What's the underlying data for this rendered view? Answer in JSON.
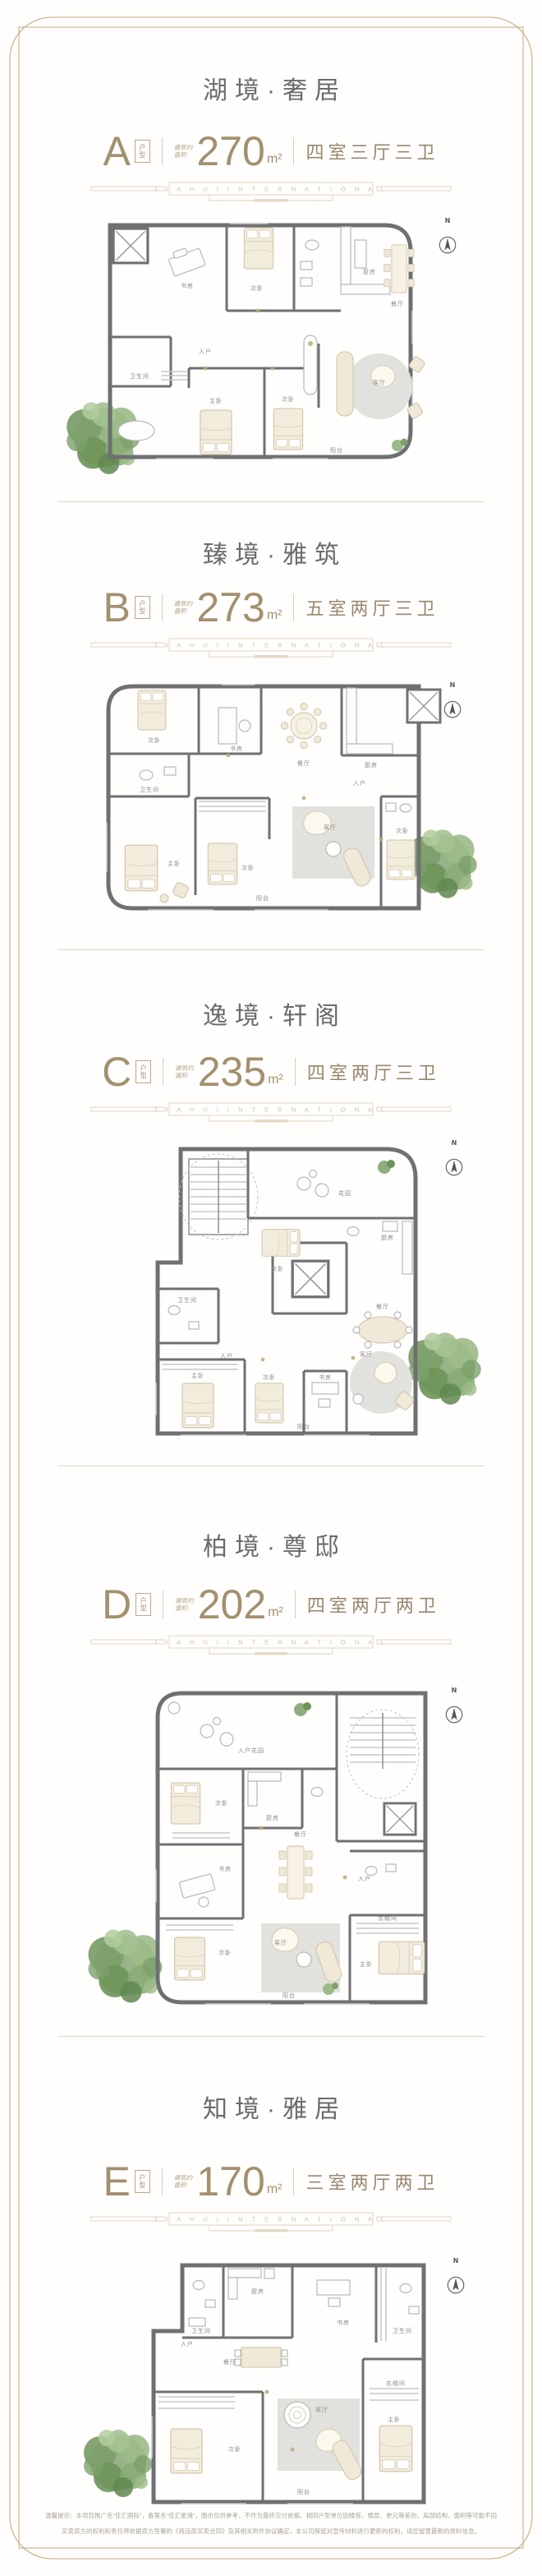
{
  "page": {
    "brand_divider": "J I A H U I   I N T E R N A T I O N A L",
    "north_label": "N",
    "type_box_top": "户",
    "type_box_bottom": "型",
    "area_note_line1": "建筑约",
    "area_note_line2": "面积",
    "disclaimer_line1": "温馨提示：本项目推广名“佳汇国际”，备案名“佳汇星滩”，图示仅供参考，不作为最终交付依据。相同户型单位因楼栋、楼层、单元等差别，局部结构、面积等可能不同，最终以实际交付为准。",
    "disclaimer_line2": "买卖双方的权利和责任将依据双方签署的《商品房买卖合同》及其相关附件协议确定，本公司保留对宣传材料进行更新的权利，请您留意最新的资料信息。"
  },
  "palette": {
    "accent_taupe": "#a3906f",
    "title_gray": "#6b6b6b",
    "frame_gold": "#c2aa7a",
    "wall_gray": "#6e7072",
    "tree_green": "#8fae7e"
  },
  "sections": [
    {
      "id": "A",
      "title": "湖境·奢居",
      "letter": "A",
      "area": "270",
      "unit": "m²",
      "layout": "四室三厅三卫",
      "rooms": [
        "书房",
        "次卧",
        "厨房",
        "餐厅",
        "入户",
        "卫生间",
        "主卧",
        "次卧",
        "客厅",
        "阳台"
      ]
    },
    {
      "id": "B",
      "title": "臻境·雅筑",
      "letter": "B",
      "area": "273",
      "unit": "m²",
      "layout": "五室两厅三卫",
      "rooms": [
        "次卧",
        "书房",
        "餐厅",
        "厨房",
        "卫生间",
        "入户",
        "主卧",
        "次卧",
        "客厅",
        "次卧",
        "阳台"
      ]
    },
    {
      "id": "C",
      "title": "逸境·轩阁",
      "letter": "C",
      "area": "235",
      "unit": "m²",
      "layout": "四室两厅三卫",
      "rooms": [
        "花园",
        "次卧",
        "厨房",
        "餐厅",
        "入户",
        "卫生间",
        "主卧",
        "次卧",
        "书房",
        "客厅",
        "阳台"
      ]
    },
    {
      "id": "D",
      "title": "柏境·尊邸",
      "letter": "D",
      "area": "202",
      "unit": "m²",
      "layout": "四室两厅两卫",
      "rooms": [
        "入户花园",
        "次卧",
        "厨房",
        "餐厅",
        "入户",
        "书房",
        "次卧",
        "客厅",
        "主卧",
        "衣帽间",
        "阳台"
      ]
    },
    {
      "id": "E",
      "title": "知境·雅居",
      "letter": "E",
      "area": "170",
      "unit": "m²",
      "layout": "三室两厅两卫",
      "rooms": [
        "卫生间",
        "厨房",
        "餐厅",
        "书房",
        "卫生间",
        "入户",
        "次卧",
        "客厅",
        "主卧",
        "衣帽间",
        "阳台"
      ]
    }
  ]
}
